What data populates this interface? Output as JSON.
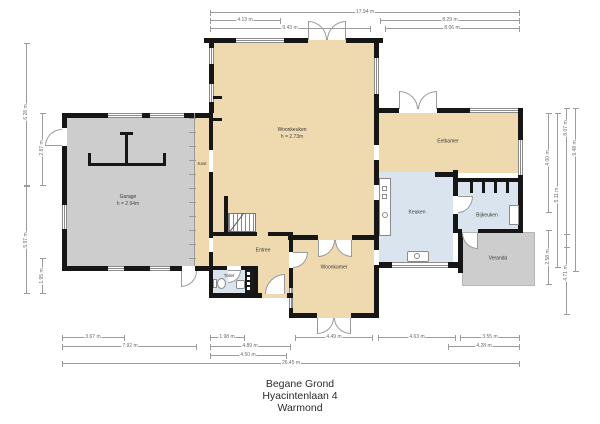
{
  "plan": {
    "title_lines": [
      "Begane Grond",
      "Hyacintenlaan 4",
      "Warmond"
    ]
  },
  "rooms": {
    "garage": {
      "name": "Garage",
      "height": "h = 2.94m"
    },
    "kast": {
      "name": "Kast"
    },
    "woonkeuken": {
      "name": "Woonkeuken",
      "height": "h = 2.73m"
    },
    "eetkamer": {
      "name": "Eetkamer"
    },
    "keuken": {
      "name": "Keuken"
    },
    "bijkeuken": {
      "name": "Bijkeuken"
    },
    "veranda": {
      "name": "Veranda"
    },
    "woonkamer": {
      "name": "Woonkamer"
    },
    "entree": {
      "name": "Entree"
    },
    "toilet": {
      "name": "Toilet"
    }
  },
  "dimensions": {
    "top": [
      "17.94 m",
      "4.13 m",
      "9.43 m",
      "8.29 m",
      "8.06 m"
    ],
    "bottom": [
      "3.67 m",
      "7.92 m",
      "1.98 m",
      "4.89 m",
      "4.50 m",
      "4.49 m",
      "4.63 m",
      "3.55 m",
      "4.28 m",
      "26.45 m"
    ],
    "left": [
      "6.28 m",
      "5.97 m",
      "2.87 m",
      "1.95 m"
    ],
    "right": [
      "4.00 m",
      "2.58 m",
      "5.11 m",
      "8.07 m",
      "4.71 m",
      "9.48 m"
    ]
  },
  "colors": {
    "room_tan": "#efd9ae",
    "room_gray": "#cdcdcd",
    "room_blue": "#d9e4ee",
    "wall": "#161616",
    "dimension_line": "#9c9c9c"
  }
}
